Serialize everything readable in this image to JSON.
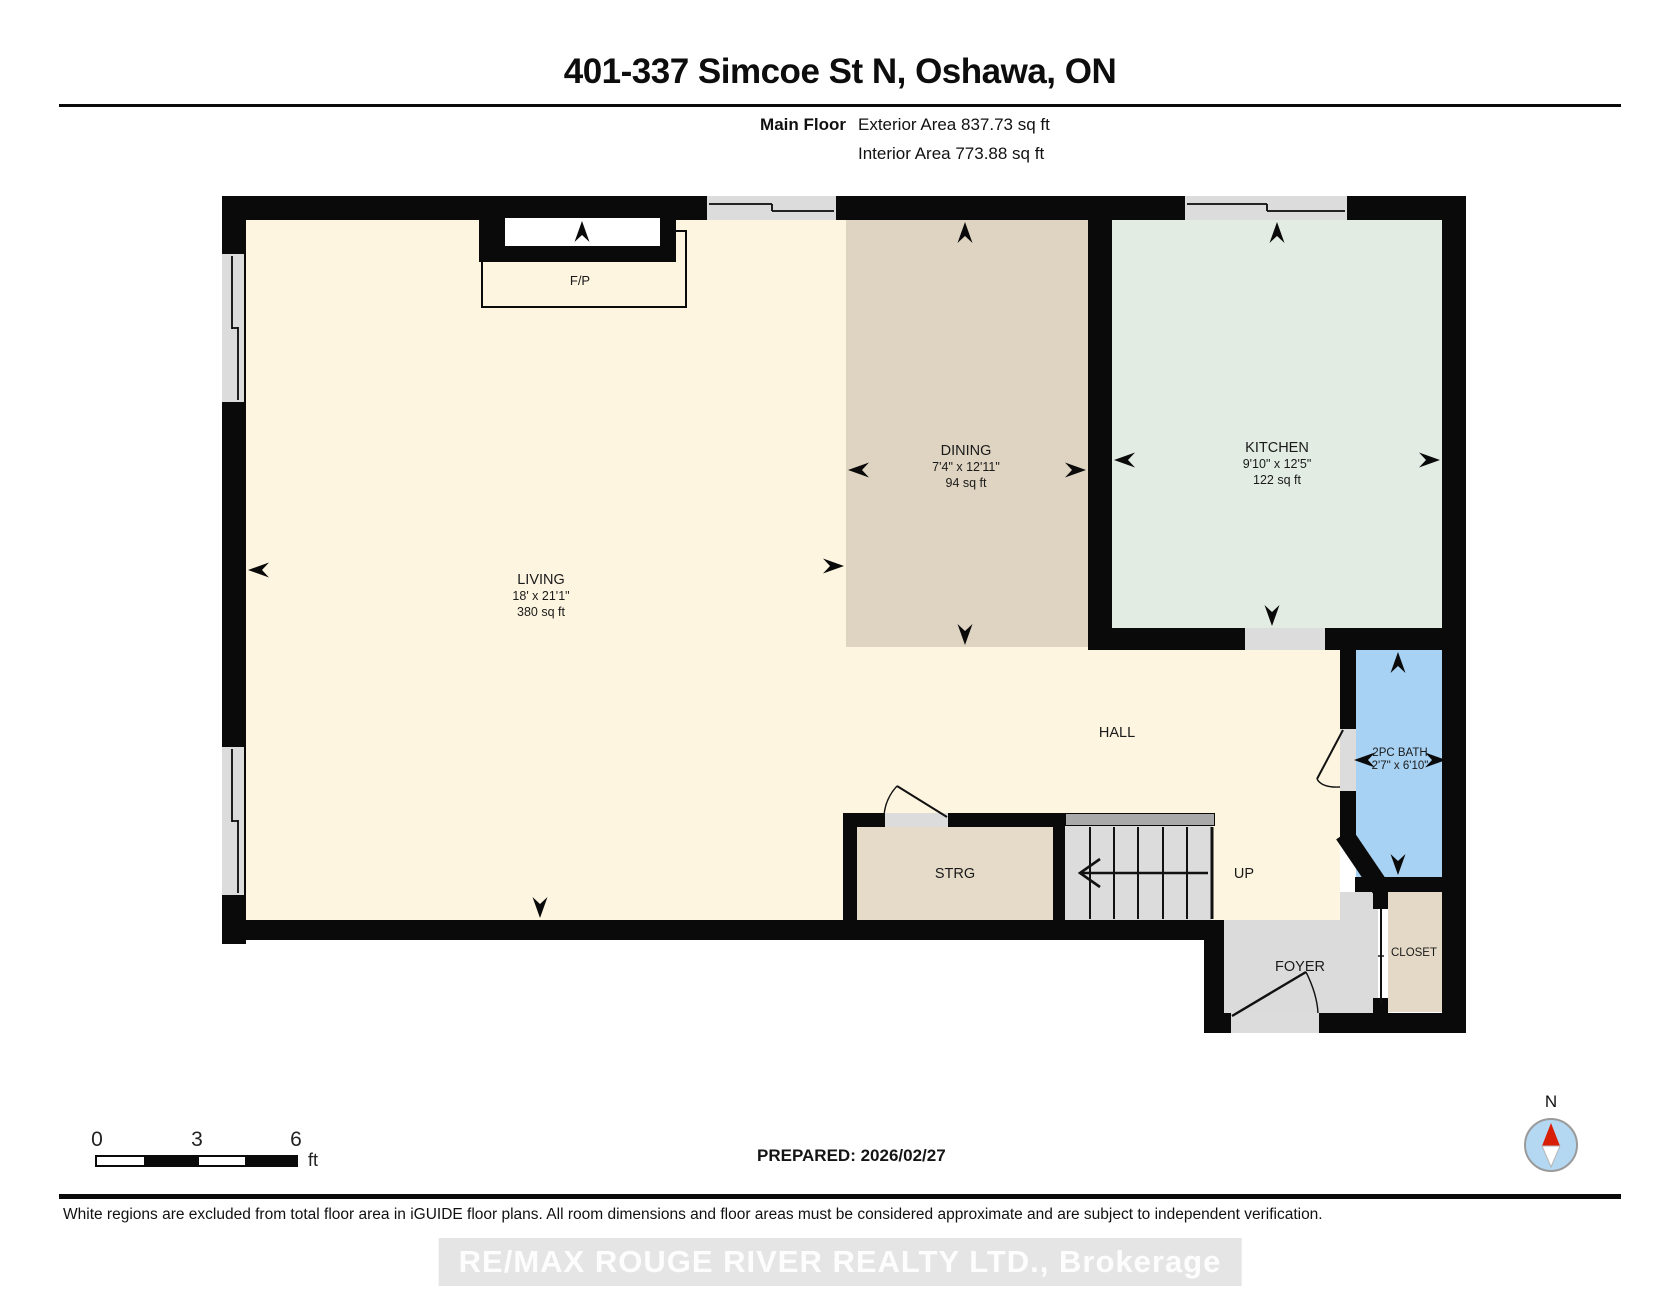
{
  "header": {
    "title": "401-337 Simcoe St N, Oshawa, ON",
    "floor_label": "Main Floor",
    "exterior_area": "Exterior Area 837.73 sq ft",
    "interior_area": "Interior Area 773.88 sq ft"
  },
  "rooms": {
    "living": {
      "name": "LIVING",
      "dims": "18' x 21'1\"",
      "area": "380 sq ft"
    },
    "dining": {
      "name": "DINING",
      "dims": "7'4\" x 12'11\"",
      "area": "94 sq ft"
    },
    "kitchen": {
      "name": "KITCHEN",
      "dims": "9'10\" x 12'5\"",
      "area": "122 sq ft"
    },
    "hall": {
      "name": "HALL"
    },
    "bath": {
      "name": "2PC BATH",
      "dims": "2'7\" x 6'10\""
    },
    "storage": {
      "name": "STRG"
    },
    "stairs": {
      "direction": "UP"
    },
    "foyer": {
      "name": "FOYER"
    },
    "closet": {
      "name": "CLOSET"
    },
    "fireplace": {
      "name": "F/P"
    }
  },
  "scale_bar": {
    "start": "0",
    "mid": "3",
    "end": "6",
    "unit": "ft"
  },
  "compass": {
    "north_label": "N"
  },
  "footer": {
    "prepared": "PREPARED: 2026/02/27",
    "disclaimer": "White regions are excluded from total floor area in iGUIDE floor plans. All room dimensions and floor areas must be considered approximate and are subject to independent verification.",
    "watermark": "RE/MAX ROUGE RIVER REALTY LTD., Brokerage"
  },
  "colors": {
    "wall": "#0a0a0a",
    "living": "#FDF5E0",
    "dining": "#DED4C1",
    "kitchen": "#E2ECE3",
    "bath": "#A8D2F3",
    "foyer": "#DBDBDB",
    "storage": "#E5DBC8",
    "closet": "#E3D9C6",
    "stairs": "#DCDCDC",
    "stair_rail": "#A9A9A9",
    "window": "#DCDCDC",
    "compass_red": "#D81E05",
    "compass_blue": "#B5D8F2",
    "watermark_bg": "#E5E5E5"
  }
}
